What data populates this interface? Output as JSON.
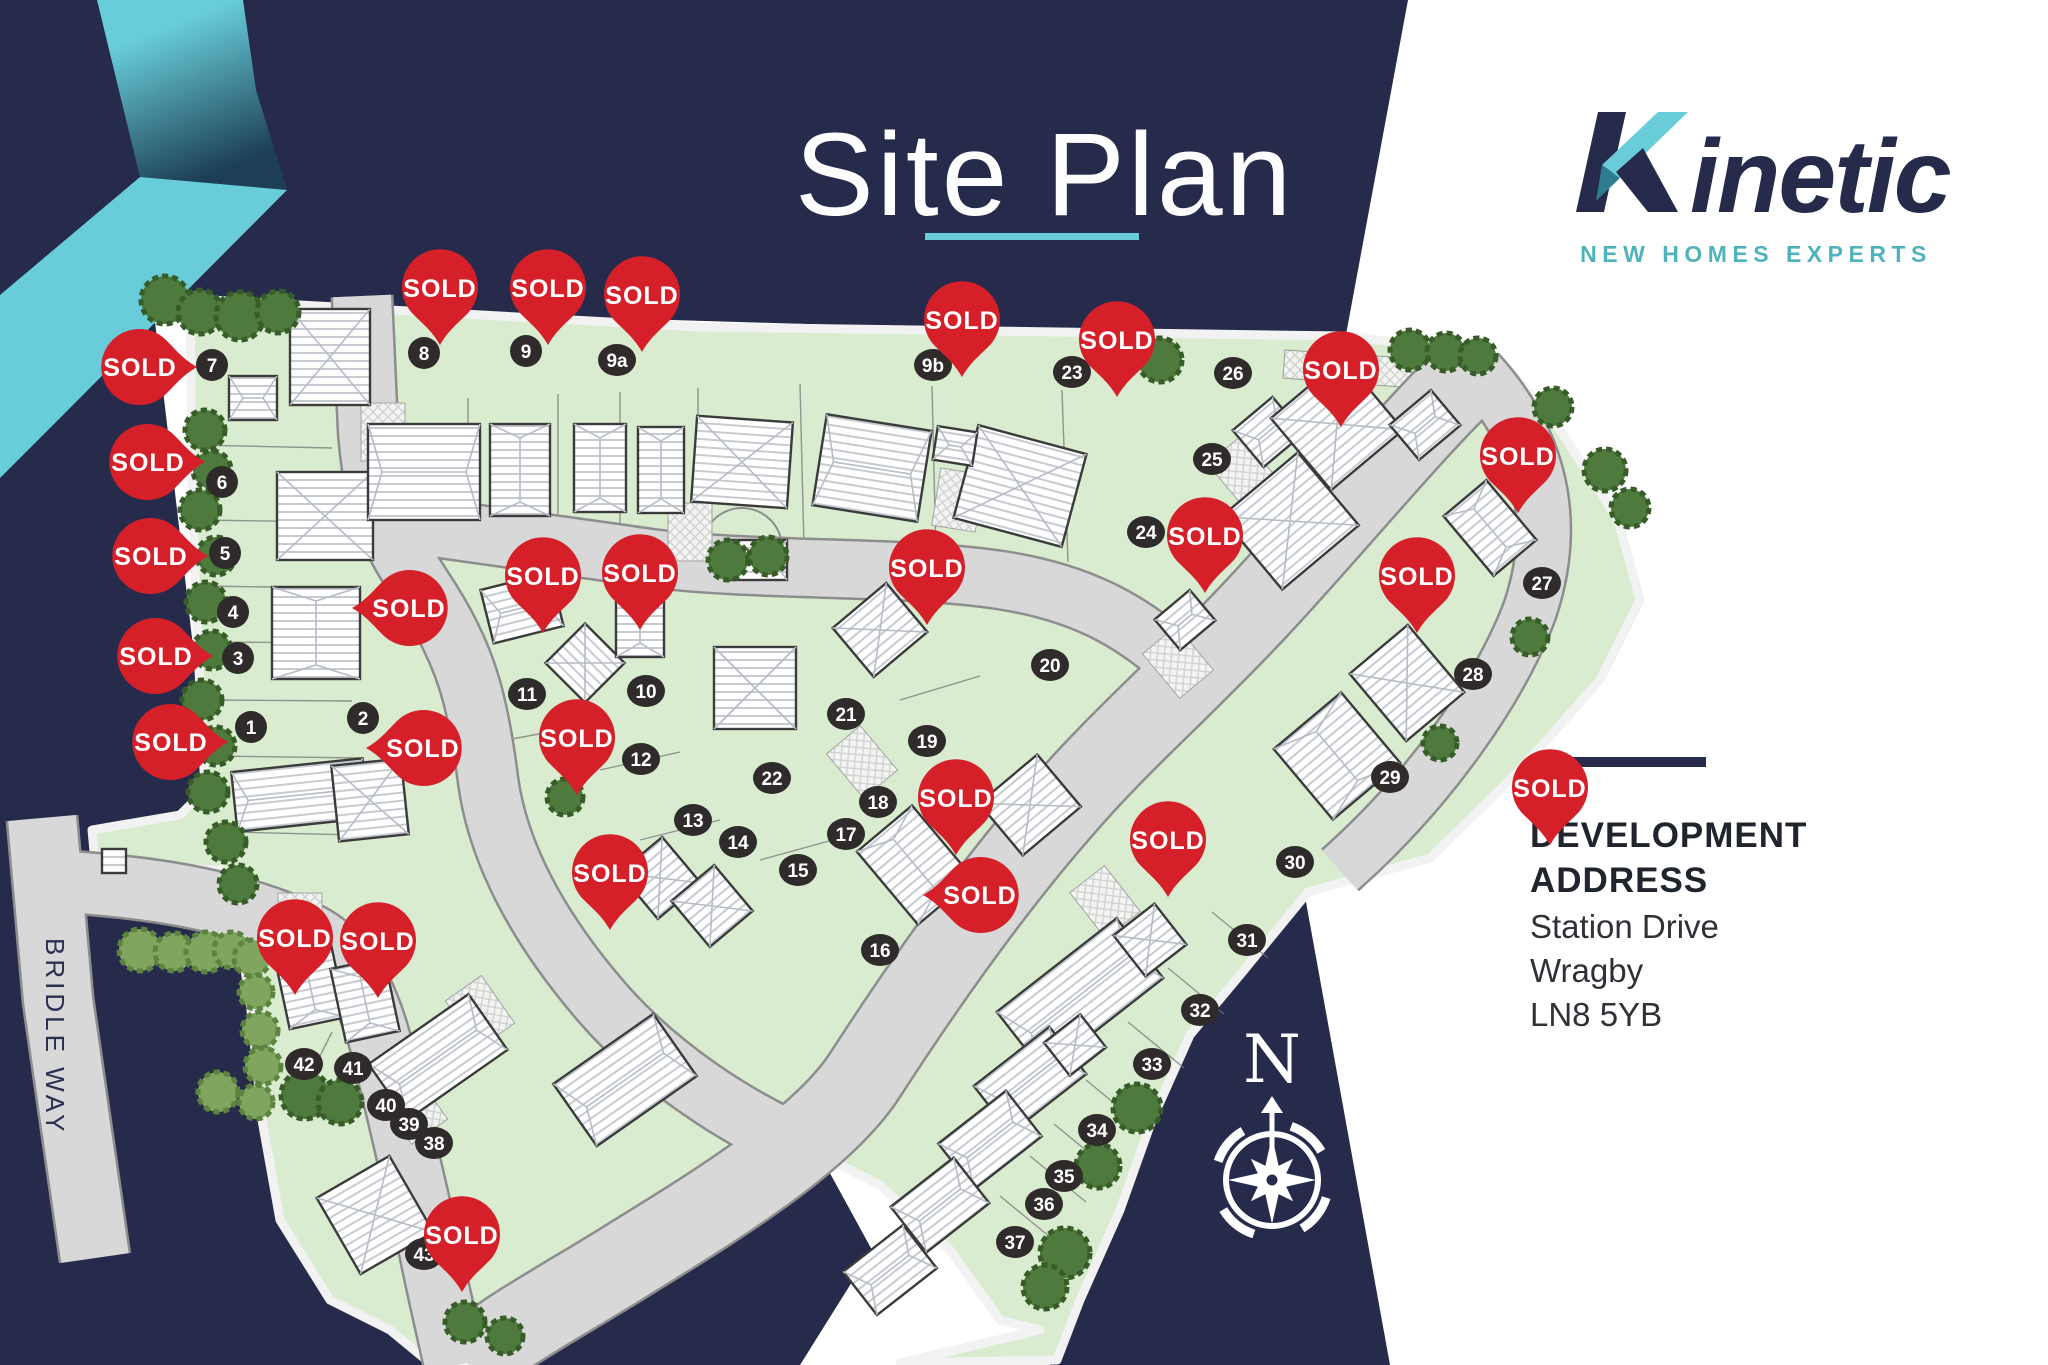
{
  "title": {
    "text": "Site Plan"
  },
  "brand": {
    "name_k": "K",
    "name_rest": "inetic",
    "tagline": "NEW HOMES EXPERTS"
  },
  "address": {
    "heading": [
      "DEVELOPMENT",
      "ADDRESS"
    ],
    "lines": [
      "Station Drive",
      "Wragby",
      "LN8 5YB"
    ]
  },
  "map": {
    "street_label": "BRIDLE WAY",
    "compass_label": "N",
    "pin_label": "SOLD",
    "plots": [
      {
        "id": "7",
        "x": 212,
        "y": 365
      },
      {
        "id": "6",
        "x": 222,
        "y": 482
      },
      {
        "id": "5",
        "x": 225,
        "y": 553
      },
      {
        "id": "4",
        "x": 233,
        "y": 612
      },
      {
        "id": "3",
        "x": 238,
        "y": 658
      },
      {
        "id": "1",
        "x": 251,
        "y": 727
      },
      {
        "id": "2",
        "x": 363,
        "y": 718
      },
      {
        "id": "8",
        "x": 424,
        "y": 353
      },
      {
        "id": "9",
        "x": 526,
        "y": 351
      },
      {
        "id": "9a",
        "x": 617,
        "y": 360
      },
      {
        "id": "9b",
        "x": 933,
        "y": 365
      },
      {
        "id": "23",
        "x": 1072,
        "y": 372
      },
      {
        "id": "26",
        "x": 1233,
        "y": 373
      },
      {
        "id": "25",
        "x": 1212,
        "y": 459
      },
      {
        "id": "24",
        "x": 1146,
        "y": 532
      },
      {
        "id": "27",
        "x": 1542,
        "y": 583
      },
      {
        "id": "28",
        "x": 1473,
        "y": 674
      },
      {
        "id": "29",
        "x": 1390,
        "y": 777
      },
      {
        "id": "11",
        "x": 527,
        "y": 694
      },
      {
        "id": "10",
        "x": 646,
        "y": 691
      },
      {
        "id": "12",
        "x": 641,
        "y": 759
      },
      {
        "id": "21",
        "x": 846,
        "y": 714
      },
      {
        "id": "22",
        "x": 772,
        "y": 778
      },
      {
        "id": "13",
        "x": 693,
        "y": 820
      },
      {
        "id": "14",
        "x": 738,
        "y": 842
      },
      {
        "id": "15",
        "x": 798,
        "y": 870
      },
      {
        "id": "19",
        "x": 927,
        "y": 741
      },
      {
        "id": "18",
        "x": 878,
        "y": 802
      },
      {
        "id": "17",
        "x": 846,
        "y": 834
      },
      {
        "id": "16",
        "x": 880,
        "y": 950
      },
      {
        "id": "20",
        "x": 1050,
        "y": 665
      },
      {
        "id": "30",
        "x": 1295,
        "y": 862
      },
      {
        "id": "31",
        "x": 1247,
        "y": 940
      },
      {
        "id": "32",
        "x": 1200,
        "y": 1010
      },
      {
        "id": "33",
        "x": 1152,
        "y": 1064
      },
      {
        "id": "34",
        "x": 1097,
        "y": 1130
      },
      {
        "id": "35",
        "x": 1064,
        "y": 1176
      },
      {
        "id": "36",
        "x": 1044,
        "y": 1204
      },
      {
        "id": "37",
        "x": 1015,
        "y": 1242
      },
      {
        "id": "42",
        "x": 304,
        "y": 1064
      },
      {
        "id": "41",
        "x": 353,
        "y": 1068
      },
      {
        "id": "40",
        "x": 386,
        "y": 1105
      },
      {
        "id": "39",
        "x": 409,
        "y": 1124
      },
      {
        "id": "38",
        "x": 434,
        "y": 1143
      },
      {
        "id": "43",
        "x": 424,
        "y": 1254
      }
    ],
    "pins": [
      {
        "x": 197,
        "y": 367,
        "dir": "right"
      },
      {
        "x": 205,
        "y": 462,
        "dir": "right"
      },
      {
        "x": 208,
        "y": 556,
        "dir": "right"
      },
      {
        "x": 213,
        "y": 656,
        "dir": "right"
      },
      {
        "x": 228,
        "y": 742,
        "dir": "right"
      },
      {
        "x": 352,
        "y": 608,
        "dir": "left"
      },
      {
        "x": 366,
        "y": 748,
        "dir": "left"
      },
      {
        "x": 923,
        "y": 895,
        "dir": "left"
      },
      {
        "x": 440,
        "y": 345,
        "dir": "down"
      },
      {
        "x": 548,
        "y": 345,
        "dir": "down"
      },
      {
        "x": 642,
        "y": 352,
        "dir": "down"
      },
      {
        "x": 962,
        "y": 377,
        "dir": "down"
      },
      {
        "x": 1117,
        "y": 397,
        "dir": "down"
      },
      {
        "x": 1341,
        "y": 427,
        "dir": "down"
      },
      {
        "x": 1205,
        "y": 593,
        "dir": "down"
      },
      {
        "x": 1518,
        "y": 513,
        "dir": "down"
      },
      {
        "x": 1417,
        "y": 633,
        "dir": "down"
      },
      {
        "x": 1550,
        "y": 845,
        "dir": "down"
      },
      {
        "x": 543,
        "y": 633,
        "dir": "down"
      },
      {
        "x": 640,
        "y": 630,
        "dir": "down"
      },
      {
        "x": 577,
        "y": 795,
        "dir": "down"
      },
      {
        "x": 610,
        "y": 930,
        "dir": "down"
      },
      {
        "x": 927,
        "y": 625,
        "dir": "down"
      },
      {
        "x": 956,
        "y": 855,
        "dir": "down"
      },
      {
        "x": 1168,
        "y": 897,
        "dir": "down"
      },
      {
        "x": 295,
        "y": 995,
        "dir": "down"
      },
      {
        "x": 378,
        "y": 998,
        "dir": "down"
      },
      {
        "x": 462,
        "y": 1292,
        "dir": "down"
      }
    ]
  },
  "colors": {
    "navy": "#262b4c",
    "teal": "#68cdd9",
    "teal_dark": "#4fb3bb",
    "red": "#d5202a",
    "green": "#d9eccf",
    "road": "#d8d8d8",
    "tree": "#4e7a3d",
    "badge": "#2f2b2a"
  }
}
